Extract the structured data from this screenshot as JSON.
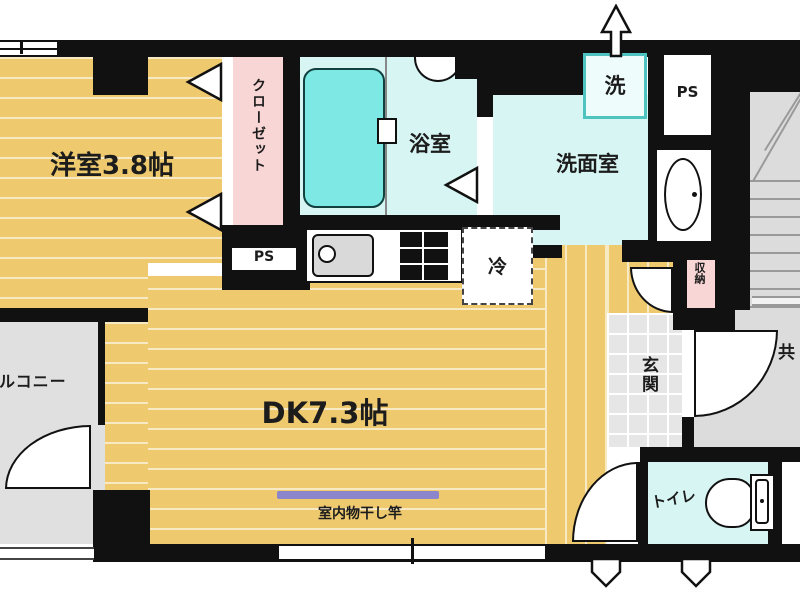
{
  "labels": {
    "western_room": "洋室3.8帖",
    "closet": "クローゼット",
    "ps_left": "PS",
    "ps_right": "PS",
    "bathroom": "浴室",
    "washroom": "洗面室",
    "washer": "洗",
    "fridge": "冷",
    "dining_kitchen": "DK7.3帖",
    "laundry_pole": "室内物干し竿",
    "balcony": "バルコニー",
    "entrance": "玄関",
    "storage": "収納",
    "toilet": "トイレ",
    "common_corridor": "共"
  },
  "colors": {
    "wall": "#111111",
    "floor_tan": "#eec96e",
    "closet_pink": "#f9d6d6",
    "wet_area_cyan": "#d6f5f3",
    "bathtub_cyan": "#7de8e4",
    "washer_frame_teal": "#4fc3c0",
    "common_gray": "#dcdcdc",
    "entrance_tile_gray": "#e6e6e6",
    "laundry_pole_purple": "#8b85cc"
  }
}
